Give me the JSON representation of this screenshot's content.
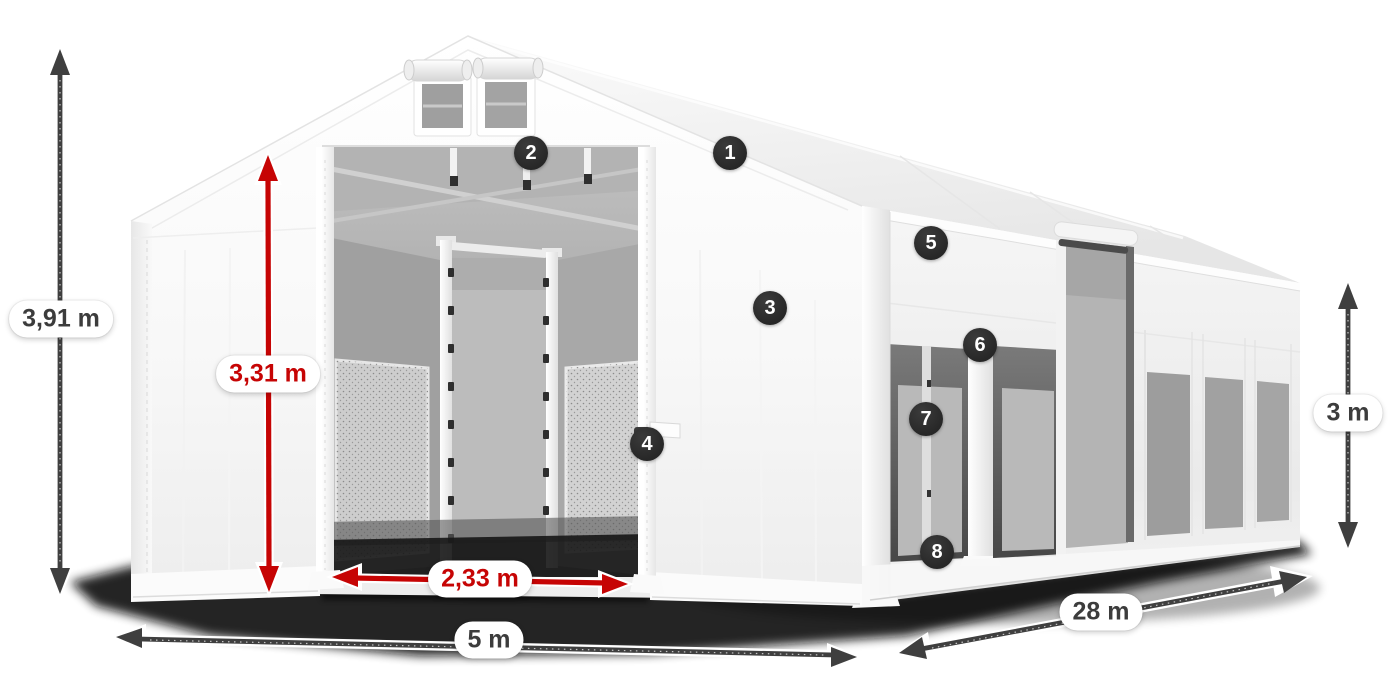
{
  "diagram": {
    "dimensions": {
      "total_height": "3,91 m",
      "entrance_height": "3,31 m",
      "entrance_width": "2,33 m",
      "width": "5 m",
      "length": "28 m",
      "side_height": "3 m"
    },
    "badges": [
      {
        "label": "1"
      },
      {
        "label": "2"
      },
      {
        "label": "3"
      },
      {
        "label": "4"
      },
      {
        "label": "5"
      },
      {
        "label": "6"
      },
      {
        "label": "7"
      },
      {
        "label": "8"
      }
    ],
    "colors": {
      "accent_red": "#c60404",
      "arrow_dark": "#3f3f3f",
      "badge_bg": "#272727",
      "pill_text": "#3c3c3c",
      "pill_bg": "#ffffff"
    }
  }
}
